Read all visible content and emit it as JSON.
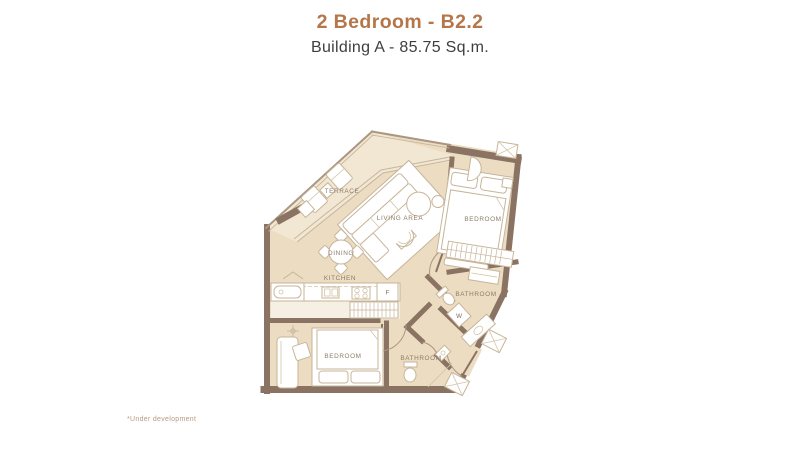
{
  "header": {
    "title": "2 Bedroom - B2.2",
    "subtitle": "Building A - 85.75 Sq.m."
  },
  "footnote": "*Under development",
  "colors": {
    "accent": "#b5764a",
    "subtitle_text": "#3e3e3e",
    "floor": "#ecdcc2",
    "terrace_floor": "#f2e7d3",
    "wall": "#8a7363",
    "label_text": "#8d7c68",
    "furniture_line": "#c7b59a",
    "footnote_text": "#b99a82"
  },
  "floorplan": {
    "rooms": [
      {
        "id": "terrace",
        "label": "TERRACE"
      },
      {
        "id": "living-area",
        "label": "LIVING AREA"
      },
      {
        "id": "dining",
        "label": "DINING"
      },
      {
        "id": "kitchen",
        "label": "KITCHEN"
      },
      {
        "id": "bedroom-1",
        "label": "BEDROOM"
      },
      {
        "id": "bathroom-1",
        "label": "BATHROOM"
      },
      {
        "id": "bedroom-2",
        "label": "BEDROOM"
      },
      {
        "id": "bathroom-2",
        "label": "BATHROOM"
      }
    ],
    "markers": [
      {
        "id": "washer",
        "label": "W"
      },
      {
        "id": "fridge",
        "label": "F"
      }
    ]
  }
}
